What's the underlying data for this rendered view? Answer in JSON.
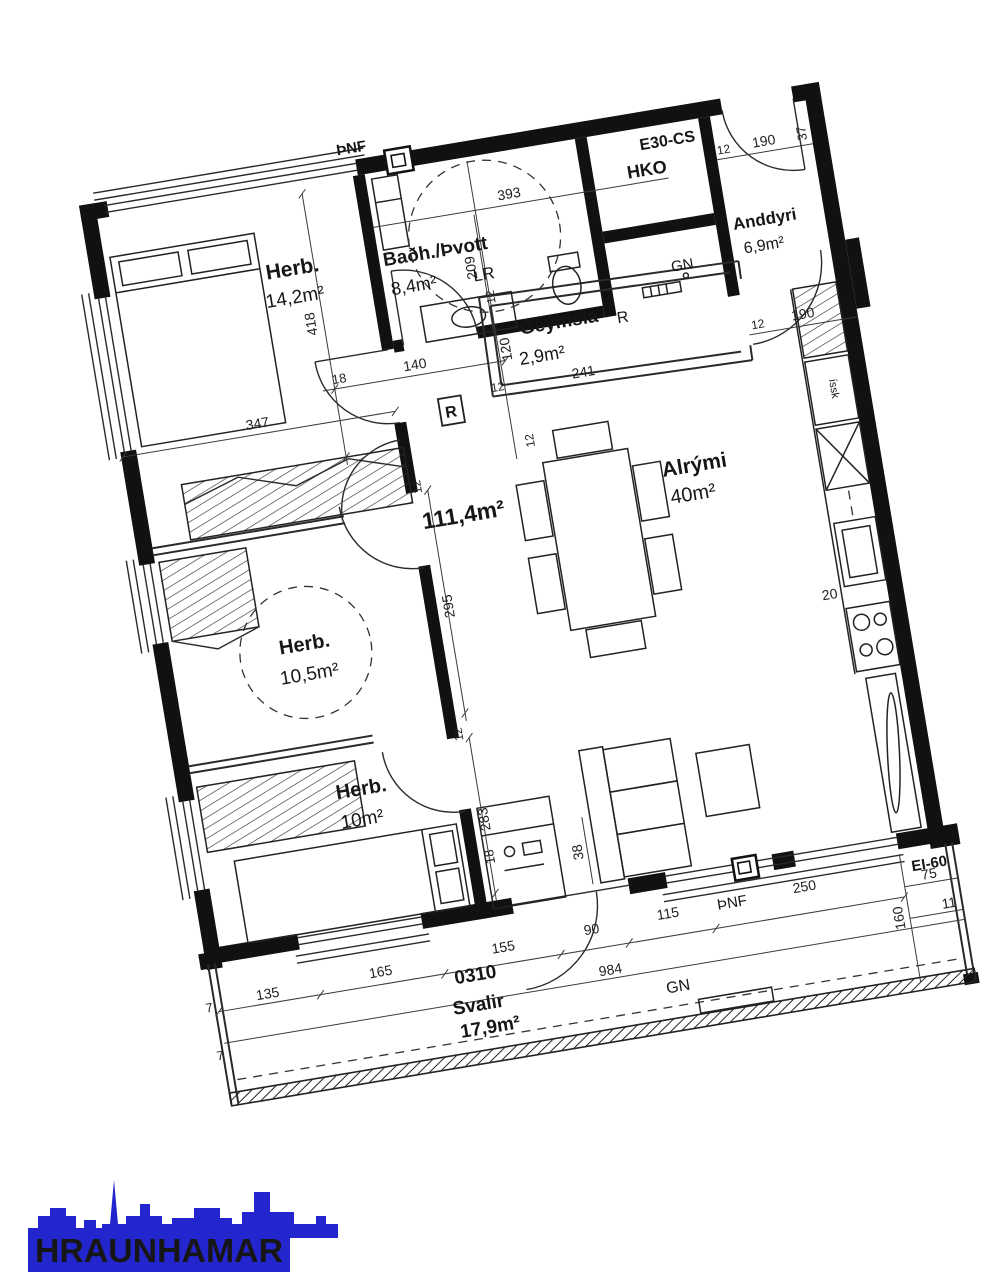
{
  "plan": {
    "total_area": "111,4m²",
    "rooms": {
      "herb1": {
        "name": "Herb.",
        "area": "14,2m²"
      },
      "herb2": {
        "name": "Herb.",
        "area": "10,5m²"
      },
      "herb3": {
        "name": "Herb.",
        "area": "10m²"
      },
      "bath": {
        "name": "Baðh./Þvott",
        "area": "8,4m²",
        "vent": "LR"
      },
      "anddyri": {
        "name": "Anddyri",
        "area": "6,9m²"
      },
      "geymsla": {
        "name": "Geymsla",
        "area": "2,9m²",
        "vent": "R"
      },
      "alrymi": {
        "name": "Alrými",
        "area": "40m²"
      },
      "svalir": {
        "name": "Svalir",
        "area": "17,9m²"
      },
      "hko": {
        "name": "HKO"
      }
    },
    "marks": {
      "pnf": "ÞNF",
      "gn": "GN",
      "r_boxed": "R",
      "e30": "E30-CS",
      "ei60": "EI-60",
      "issk": "íssk",
      "stamp": "0310"
    },
    "dims": {
      "d7": "7",
      "d11": "11",
      "d12": "12",
      "d18": "18",
      "d20": "20",
      "d37": "37",
      "d38": "38",
      "d75": "75",
      "d90": "90",
      "d115": "115",
      "d120": "120",
      "d135": "135",
      "d140": "140",
      "d155": "155",
      "d160": "160",
      "d165": "165",
      "d190": "190",
      "d209": "209",
      "d241": "241",
      "d250": "250",
      "d283": "283",
      "d295": "295",
      "d347": "347",
      "d393": "393",
      "d418": "418",
      "d984": "984"
    }
  },
  "logo": {
    "text": "HRAUNHAMAR",
    "color": "#2426cd"
  }
}
